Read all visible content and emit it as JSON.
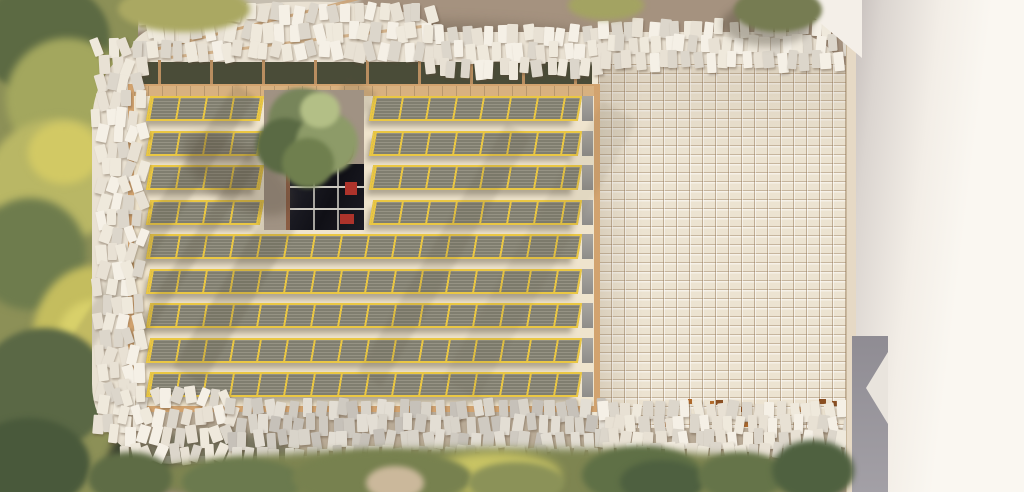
{
  "scene": {
    "kind": "aerial-architectural-rendering",
    "width": 1024,
    "height": 492,
    "seed": 7
  },
  "palette": {
    "ground": "#a5927f",
    "ground_shade": "#8f7d6c",
    "deck_surface": "#efe4cd",
    "deck_frame": "#d2a36f",
    "panel_frame": "#eac743",
    "panel_fill": "#8f8c7c",
    "canopy_base": "#e9e1d2",
    "understory_dark": "#4a4c38",
    "under_ground": "#b9ab97",
    "skylight_red": "#ad332b",
    "neighbor_white": "#faf7f1",
    "alley_grey": "#a3a0a6"
  },
  "ground": {
    "base": {
      "x": 0,
      "y": 0,
      "w": 1024,
      "h": 492,
      "color": "#a5927f"
    },
    "shade_top_left": {
      "x": 120,
      "y": 20,
      "w": 470,
      "h": 30,
      "color": "rgba(111,98,83,.45)",
      "blur": 6
    }
  },
  "paths": [
    {
      "x": 40,
      "y": -10,
      "w": 320,
      "h": 34,
      "rot": -7,
      "color": "#c6beb0",
      "blur": 2
    },
    {
      "x": 98,
      "y": 382,
      "w": 24,
      "h": 115,
      "rot": 3,
      "color": "#b1a89c",
      "blur": 1
    }
  ],
  "vegetation_left": {
    "base": {
      "x": -4,
      "y": -4,
      "w": 142,
      "h": 500,
      "color": "#8c9057"
    },
    "blobs": [
      {
        "x": -22,
        "y": -18,
        "w": 132,
        "h": 112,
        "color": "#5c6a43",
        "blur": 3
      },
      {
        "x": 6,
        "y": 38,
        "w": 122,
        "h": 122,
        "color": "#a3a75e",
        "blur": 4
      },
      {
        "x": -12,
        "y": 118,
        "w": 142,
        "h": 122,
        "color": "#b9b765",
        "blur": 4
      },
      {
        "x": 28,
        "y": 122,
        "w": 72,
        "h": 62,
        "color": "#d2c964",
        "blur": 4
      },
      {
        "x": -26,
        "y": 198,
        "w": 112,
        "h": 112,
        "color": "#6e7c4d",
        "blur": 4
      },
      {
        "x": 32,
        "y": 266,
        "w": 122,
        "h": 152,
        "color": "#c4bd5e",
        "blur": 4
      },
      {
        "x": 58,
        "y": 300,
        "w": 72,
        "h": 72,
        "color": "#d8d06a",
        "blur": 4
      },
      {
        "x": -22,
        "y": 328,
        "w": 132,
        "h": 122,
        "color": "#5a6845",
        "blur": 3
      },
      {
        "x": -32,
        "y": 418,
        "w": 122,
        "h": 92,
        "color": "#49593b",
        "blur": 3
      },
      {
        "x": 108,
        "y": 428,
        "w": 62,
        "h": 70,
        "color": "#3d4431",
        "blur": 4
      }
    ]
  },
  "trees_top": [
    {
      "x": 118,
      "y": -14,
      "w": 132,
      "h": 46,
      "color": "#aaa862",
      "blur": 3
    },
    {
      "x": 568,
      "y": -10,
      "w": 76,
      "h": 30,
      "color": "#a3a362",
      "blur": 3
    },
    {
      "x": 722,
      "y": 2,
      "w": 90,
      "h": 44,
      "color": "rgba(70,64,48,.35)",
      "blur": 4
    },
    {
      "x": 734,
      "y": -12,
      "w": 88,
      "h": 44,
      "color": "#767c52",
      "blur": 2
    }
  ],
  "canopy": {
    "base": {
      "x": 92,
      "y": 32,
      "w": 756,
      "h": 432,
      "radius": "90px 60px 120px 80px",
      "color": "#e9e1d2"
    },
    "arch": {
      "x": 132,
      "y": 2,
      "w": 304,
      "h": 80,
      "radius": "45% 55% 20% 20%",
      "rot": -4,
      "color": "#e9e1d2"
    },
    "understory_top": {
      "x": 138,
      "y": 62,
      "w": 462,
      "h": 28,
      "color": "#4a4c38"
    },
    "understory_bottom": {
      "x": 126,
      "y": 404,
      "w": 722,
      "h": 52,
      "color": "#b9ab97"
    },
    "understory_bottom_dark": {
      "x": 120,
      "y": 430,
      "w": 180,
      "h": 60,
      "color": "rgba(62,70,48,.55)",
      "blur": 5
    },
    "posts": {
      "x0": 158,
      "x1": 590,
      "step": 52,
      "y": 60,
      "w": 3,
      "h": 32
    },
    "beams": [
      {
        "x": 150,
        "y": 18,
        "w": 250,
        "h": 3,
        "rot": -14,
        "color": "rgba(202,161,115,.85)"
      },
      {
        "x": 170,
        "y": 40,
        "w": 260,
        "h": 3,
        "rot": -7,
        "color": "rgba(202,161,115,.75)"
      }
    ],
    "tile_palette": [
      "#f5f0e6",
      "#efe9dc",
      "#e8e1d4",
      "#dcd6cb"
    ],
    "tile_palette_shaded": [
      "#e3ded4",
      "#d9d4ca",
      "#cfcac1",
      "#c6c1b9"
    ],
    "bands": [
      {
        "x": 138,
        "y": 4,
        "w": 300,
        "h": 58,
        "rows": 3,
        "cols": 25,
        "rot": 16,
        "shaded": false
      },
      {
        "x": 425,
        "y": 26,
        "w": 180,
        "h": 50,
        "rows": 3,
        "cols": 15,
        "rot": 9,
        "shaded": false
      },
      {
        "x": 600,
        "y": 20,
        "w": 246,
        "h": 48,
        "rows": 3,
        "cols": 21,
        "rot": 7,
        "shaded": false
      },
      {
        "x": 94,
        "y": 40,
        "w": 48,
        "h": 392,
        "rows": 23,
        "cols": 4,
        "rot": 22,
        "shaded": false
      },
      {
        "x": 112,
        "y": 388,
        "w": 124,
        "h": 76,
        "rows": 4,
        "cols": 10,
        "rot": 24,
        "shaded": false
      },
      {
        "x": 228,
        "y": 400,
        "w": 378,
        "h": 62,
        "rows": 4,
        "cols": 31,
        "rot": 11,
        "shaded": true
      },
      {
        "x": 598,
        "y": 402,
        "w": 250,
        "h": 56,
        "rows": 4,
        "cols": 21,
        "rot": 11,
        "shaded": false
      }
    ],
    "tile_size": {
      "w": 10,
      "h": 18
    }
  },
  "tile_grid_roof": {
    "rect": {
      "x": 598,
      "y": 64,
      "w": 248,
      "h": 364
    },
    "edge_strip": {
      "x": 592,
      "y": 64,
      "w": 8,
      "h": 364,
      "color": "#f0e8d6"
    },
    "shade_overlay": "linear-gradient(180deg, rgba(120,100,75,.14), rgba(0,0,0,0) 26%), linear-gradient(90deg, rgba(120,100,75,.16), rgba(0,0,0,0) 18%)",
    "accents": {
      "count": 14,
      "y0": 398,
      "y1": 424,
      "x0": 604,
      "x1": 836,
      "colors": [
        "#b06a2c",
        "#8a4f22"
      ]
    }
  },
  "deck": {
    "rect": {
      "x": 128,
      "y": 84,
      "w": 472,
      "h": 328
    },
    "top_band": {
      "x": 134,
      "y": 86,
      "w": 460,
      "h": 10,
      "color": "#d8b180"
    },
    "panel_row_height": 25,
    "rows": [
      {
        "y": 96,
        "segments": [
          {
            "x": 148,
            "w": 114
          },
          {
            "x": 371,
            "w": 209
          }
        ]
      },
      {
        "y": 131,
        "segments": [
          {
            "x": 148,
            "w": 114
          },
          {
            "x": 371,
            "w": 209
          }
        ]
      },
      {
        "y": 165,
        "segments": [
          {
            "x": 148,
            "w": 114
          },
          {
            "x": 371,
            "w": 209
          }
        ]
      },
      {
        "y": 200,
        "segments": [
          {
            "x": 148,
            "w": 114
          },
          {
            "x": 371,
            "w": 209
          }
        ]
      },
      {
        "y": 234,
        "segments": [
          {
            "x": 148,
            "w": 432
          }
        ]
      },
      {
        "y": 269,
        "segments": [
          {
            "x": 148,
            "w": 432
          }
        ]
      },
      {
        "y": 303,
        "segments": [
          {
            "x": 148,
            "w": 432
          }
        ]
      },
      {
        "y": 338,
        "segments": [
          {
            "x": 148,
            "w": 432
          }
        ]
      },
      {
        "y": 372,
        "segments": [
          {
            "x": 148,
            "w": 432
          }
        ]
      }
    ],
    "end_cap": {
      "x": 582,
      "w": 11
    },
    "shadow_stripes": [
      {
        "x": 152,
        "y": 66,
        "w": 24,
        "h": 300,
        "rot": 33,
        "op": 0.18
      },
      {
        "x": 208,
        "y": 66,
        "w": 15,
        "h": 300,
        "rot": 33,
        "op": 0.16
      },
      {
        "x": 258,
        "y": 60,
        "w": 34,
        "h": 340,
        "rot": 31,
        "op": 0.18
      },
      {
        "x": 430,
        "y": 110,
        "w": 28,
        "h": 290,
        "rot": 31,
        "op": 0.12
      },
      {
        "x": 520,
        "y": 90,
        "w": 40,
        "h": 320,
        "rot": 30,
        "op": 0.08
      }
    ]
  },
  "courtyard": {
    "terrace": {
      "x": 264,
      "y": 90,
      "w": 100,
      "h": 140,
      "color": "#a09283"
    },
    "wood_post": {
      "x": 286,
      "y": 150,
      "w": 6,
      "h": 80,
      "color": "#8a5c43"
    },
    "skylight": {
      "x": 290,
      "y": 164,
      "w": 74,
      "h": 66
    },
    "mullions_h": [
      186,
      208
    ],
    "mullions_v": [
      313,
      337
    ],
    "red_items": [
      {
        "x": 345,
        "y": 182,
        "w": 12,
        "h": 13
      },
      {
        "x": 340,
        "y": 214,
        "w": 14,
        "h": 10
      }
    ],
    "pot": {
      "x": 316,
      "y": 130,
      "w": 38,
      "h": 38,
      "color": "#b05f3d",
      "rim": "#7d4530"
    },
    "tree_blobs": [
      {
        "x": 268,
        "y": 88,
        "w": 68,
        "h": 66,
        "color": "#77855a",
        "blur": 2
      },
      {
        "x": 256,
        "y": 118,
        "w": 58,
        "h": 56,
        "color": "#5a6a44",
        "blur": 2
      },
      {
        "x": 296,
        "y": 112,
        "w": 62,
        "h": 62,
        "color": "#8d9b68",
        "blur": 2
      },
      {
        "x": 282,
        "y": 138,
        "w": 52,
        "h": 50,
        "color": "#6f7f4e",
        "blur": 2
      },
      {
        "x": 300,
        "y": 92,
        "w": 40,
        "h": 36,
        "color": "#b3bf86",
        "blur": 2
      }
    ],
    "tree_shadow": {
      "x": 176,
      "y": 146,
      "w": 124,
      "h": 58,
      "rot": 32,
      "color": "rgba(75,66,52,.28)",
      "blur": 5
    }
  },
  "neighbor": {
    "wall_strip": {
      "x": 846,
      "y": 0,
      "w": 12,
      "h": 492,
      "color": "#e6d9c5"
    },
    "roof": {
      "x": 856,
      "y": 0,
      "w": 168,
      "h": 492,
      "gradient": "linear-gradient(97deg,#c7c0bd 0%,#dbd5d0 12%,#f3eee7 38%,#faf7f1 60%)"
    },
    "top_wedge": {
      "points": "793,0 862,0 862,58",
      "color": "#f4efe8"
    },
    "alley": {
      "x": 852,
      "y": 336,
      "w": 36,
      "h": 156,
      "color": "#a3a0a6"
    },
    "alley_notch": {
      "points": "888,352 888,424 866,388",
      "color": "#e9e4dd"
    }
  },
  "trees_bottom": [
    {
      "x": 138,
      "y": 448,
      "w": 712,
      "h": 60,
      "color": "#7e8551",
      "blur": 4,
      "isbase": true
    },
    {
      "x": 430,
      "y": 452,
      "w": 130,
      "h": 44,
      "color": "#c9c464",
      "blur": 5
    },
    {
      "x": 88,
      "y": 452,
      "w": 84,
      "h": 52,
      "color": "#5e6c45",
      "blur": 3
    },
    {
      "x": 182,
      "y": 458,
      "w": 120,
      "h": 48,
      "color": "#6b7a4e",
      "blur": 3
    },
    {
      "x": 292,
      "y": 450,
      "w": 180,
      "h": 56,
      "color": "#77814f",
      "blur": 3
    },
    {
      "x": 366,
      "y": 466,
      "w": 58,
      "h": 34,
      "color": "#cbb89b",
      "blur": 3
    },
    {
      "x": 468,
      "y": 462,
      "w": 96,
      "h": 42,
      "color": "#8b9258",
      "blur": 3
    },
    {
      "x": 582,
      "y": 446,
      "w": 120,
      "h": 58,
      "color": "#5f7046",
      "blur": 3
    },
    {
      "x": 620,
      "y": 460,
      "w": 84,
      "h": 44,
      "color": "#4e6040",
      "blur": 3
    },
    {
      "x": 698,
      "y": 452,
      "w": 86,
      "h": 48,
      "color": "#657449",
      "blur": 3
    },
    {
      "x": 772,
      "y": 440,
      "w": 82,
      "h": 60,
      "color": "#4f6140",
      "blur": 3
    }
  ]
}
